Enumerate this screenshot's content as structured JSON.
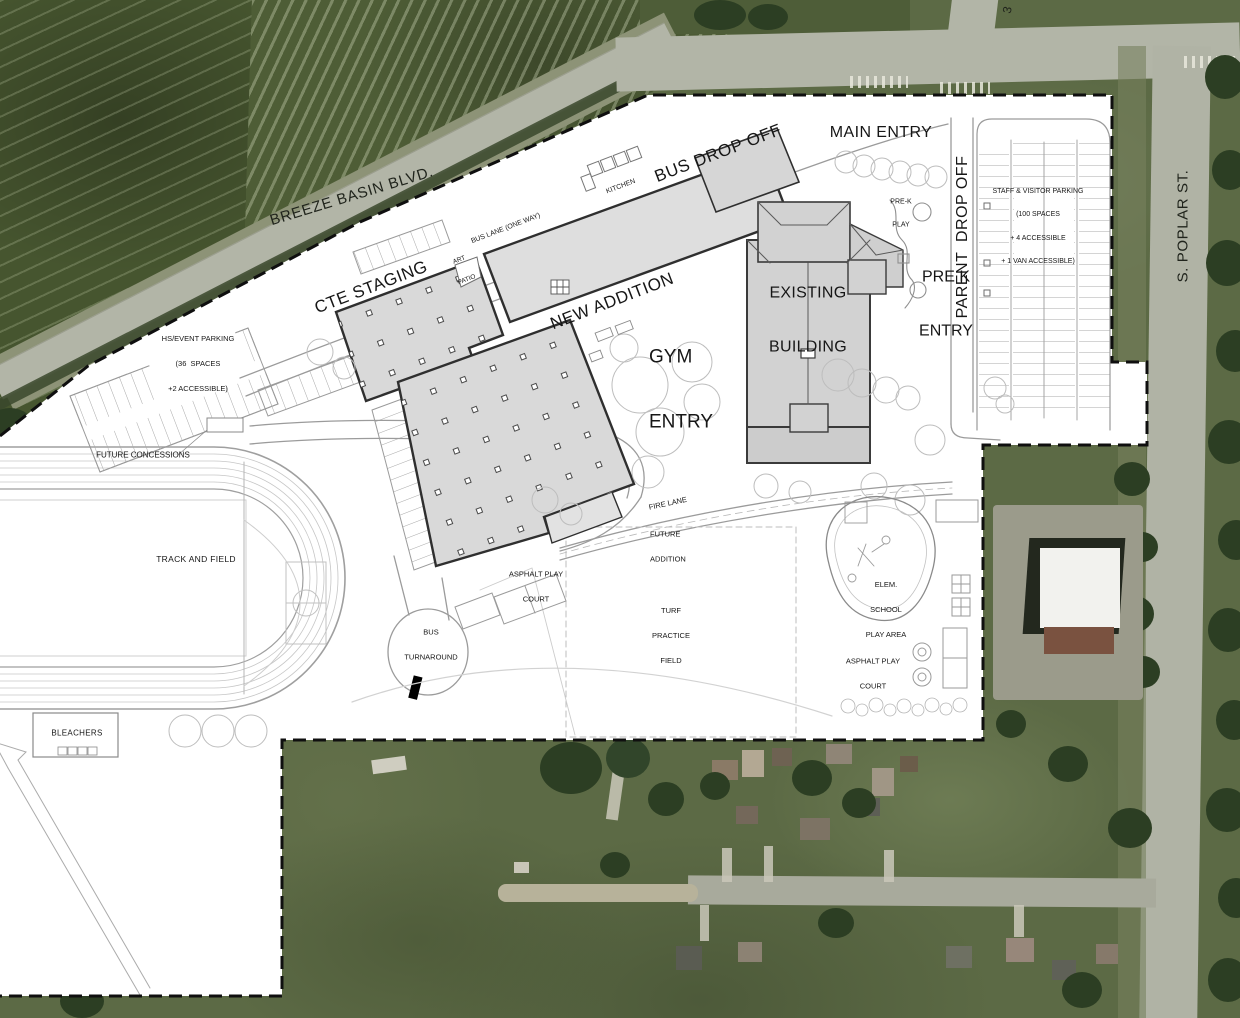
{
  "drawing": {
    "title": "school campus site plan over aerial photo",
    "streets": {
      "breeze_basin_blvd": "BREEZE BASIN BLVD.",
      "s_poplar_st": "S. POPLAR ST.",
      "street_number_partial": "3"
    },
    "labels": {
      "bus_drop_off": "BUS DROP OFF",
      "main_entry": "MAIN ENTRY",
      "kitchen": "KITCHEN",
      "bus_lane": "BUS LANE (ONE WAY)",
      "cte_staging": "CTE STAGING",
      "art_patio_line1": "ART",
      "art_patio_line2": "PATIO",
      "new_addition": "NEW ADDITION",
      "existing_building_line1": "EXISTING",
      "existing_building_line2": "BUILDING",
      "pre_k_play_line1": "PRE-K",
      "pre_k_play_line2": "PLAY",
      "parent_drop_off": "PARENT  DROP OFF",
      "pre_k_entry_line1": "PRE K",
      "pre_k_entry_line2": "ENTRY",
      "staff_parking_line1": "STAFF & VISITOR PARKING",
      "staff_parking_line2": "(100 SPACES",
      "staff_parking_line3": "+ 4 ACCESSIBLE",
      "staff_parking_line4": "+ 1 VAN ACCESSIBLE)",
      "hs_parking_line1": "HS/EVENT PARKING",
      "hs_parking_line2": "(36  SPACES",
      "hs_parking_line3": "+2 ACCESSIBLE)",
      "gym_entry_line1": "GYM",
      "gym_entry_line2": "ENTRY",
      "future_concessions": "FUTURE CONCESSIONS",
      "track_and_field": "TRACK AND FIELD",
      "fire_lane": "FIRE LANE",
      "future_addition_line1": "FUTURE",
      "future_addition_line2": "ADDITION",
      "asphalt_court_center_line1": "ASPHALT PLAY",
      "asphalt_court_center_line2": "COURT",
      "bus_turnaround_line1": "BUS",
      "bus_turnaround_line2": "TURNAROUND",
      "turf_field_line1": "TURF",
      "turf_field_line2": "PRACTICE",
      "turf_field_line3": "FIELD",
      "elem_play_line1": "ELEM.",
      "elem_play_line2": "SCHOOL",
      "elem_play_line3": "PLAY AREA",
      "asphalt_court_east_line1": "ASPHALT PLAY",
      "asphalt_court_east_line2": "COURT",
      "bleachers": "BLEACHERS"
    },
    "colors": {
      "plan_background": "#ffffff",
      "building_fill": "#d9d9d9",
      "building_outline": "#2f2f2f",
      "boundary_dash": "#0f0f0f",
      "farmland_green": "#4e5d36",
      "road_gray": "#b2b5a7",
      "lawn_green": "#5c6a45",
      "tree_green": "#2c3e23"
    }
  }
}
